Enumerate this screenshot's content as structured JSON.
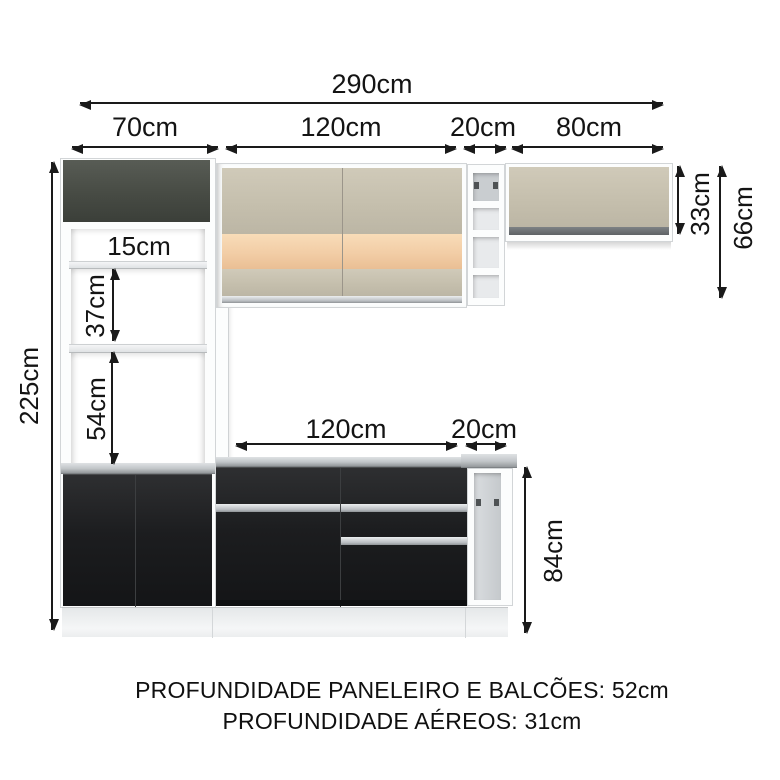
{
  "title": "Diagrama de medidas de cozinha modulada",
  "dims": {
    "total_width": "290cm",
    "tall_cabinet_width": "70cm",
    "upper_cabinet_width": "120cm",
    "niche_width": "20cm",
    "wall_cabinet_width": "80cm",
    "total_height": "225cm",
    "top_gap_height": "15cm",
    "middle_gap_height": "37cm",
    "lower_gap_height": "54cm",
    "wall_cabinet_height": "33cm",
    "upper_cabinet_height": "66cm",
    "base_cabinet_width": "120cm",
    "base_end_width": "20cm",
    "base_height": "84cm"
  },
  "notes": {
    "line1": "PROFUNDIDADE PANELEIRO E BALCÕES: 52cm",
    "line2": "PROFUNDIDADE AÉREOS: 31cm"
  },
  "colors": {
    "dark_door": "#474b44",
    "cream_door": "#c4beac",
    "accent_strip": "#f2cda6",
    "black_base": "#1c1d1f",
    "silver_handle": "#b9bdc1",
    "frame_white": "#fcfdfd",
    "arrow": "#1a1a1a"
  }
}
